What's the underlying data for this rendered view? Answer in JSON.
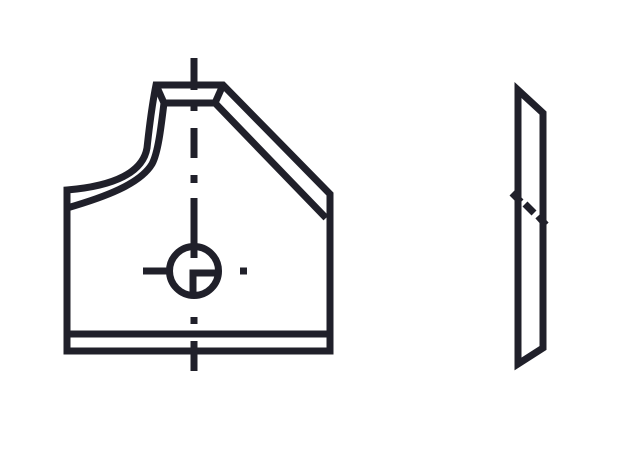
{
  "page": {
    "background_color": "#ffffff"
  },
  "drawing": {
    "name": "insert-knife-technical-drawing",
    "description_names": {
      "left": "front-view",
      "right": "side-view"
    },
    "stroke_color": "#20202a",
    "stroke_width": 7,
    "canvas": {
      "width": 630,
      "height": 451
    },
    "shapes": [
      {
        "name": "front-view-outline",
        "kind": "path",
        "d": "M156 85 L223 85 L330 194 L330 351 L67 351 L67 190 C115 186 143 172 147 148 C149 130 151 110 156 85 Z"
      },
      {
        "name": "front-view-inner-profile-and-chamfer",
        "kind": "path",
        "d": "M67 208 C105 197 140 184 152 164 C158 153 161 128 164 103 L215 103 L326 218"
      },
      {
        "name": "front-view-top-face-left-bevel",
        "kind": "path",
        "d": "M156 85 L164 103"
      },
      {
        "name": "front-view-top-face-right-bevel",
        "kind": "path",
        "d": "M223 85 L215 103"
      },
      {
        "name": "front-view-bottom-land-line",
        "kind": "path",
        "d": "M67 334 L330 334"
      },
      {
        "name": "screw-hole-circle",
        "kind": "circle",
        "cx": 194,
        "cy": 271,
        "r": 24.5
      },
      {
        "name": "screw-hole-quadrant-lines",
        "kind": "path",
        "d": "M216 273 L193 273 L193 295"
      },
      {
        "name": "vertical-centerline",
        "kind": "path",
        "d": "M194 58 L194 90 M194 104 L194 111 M194 128 L194 158 M194 175 L194 183 M194 198 L194 258 M194 317 L194 324 M194 341 L194 371"
      },
      {
        "name": "horizontal-centerline",
        "kind": "path",
        "d": "M143 271 L170 271 M240 271 L247 271"
      },
      {
        "name": "side-view-outline",
        "kind": "path",
        "d": "M518 90 L543 113 L543 348 L518 364 Z"
      },
      {
        "name": "side-view-diagonal-edge-marks",
        "kind": "path",
        "d": "M512 193 L521 202 M525 204 L534 213 M538 216 L546 225"
      }
    ]
  }
}
